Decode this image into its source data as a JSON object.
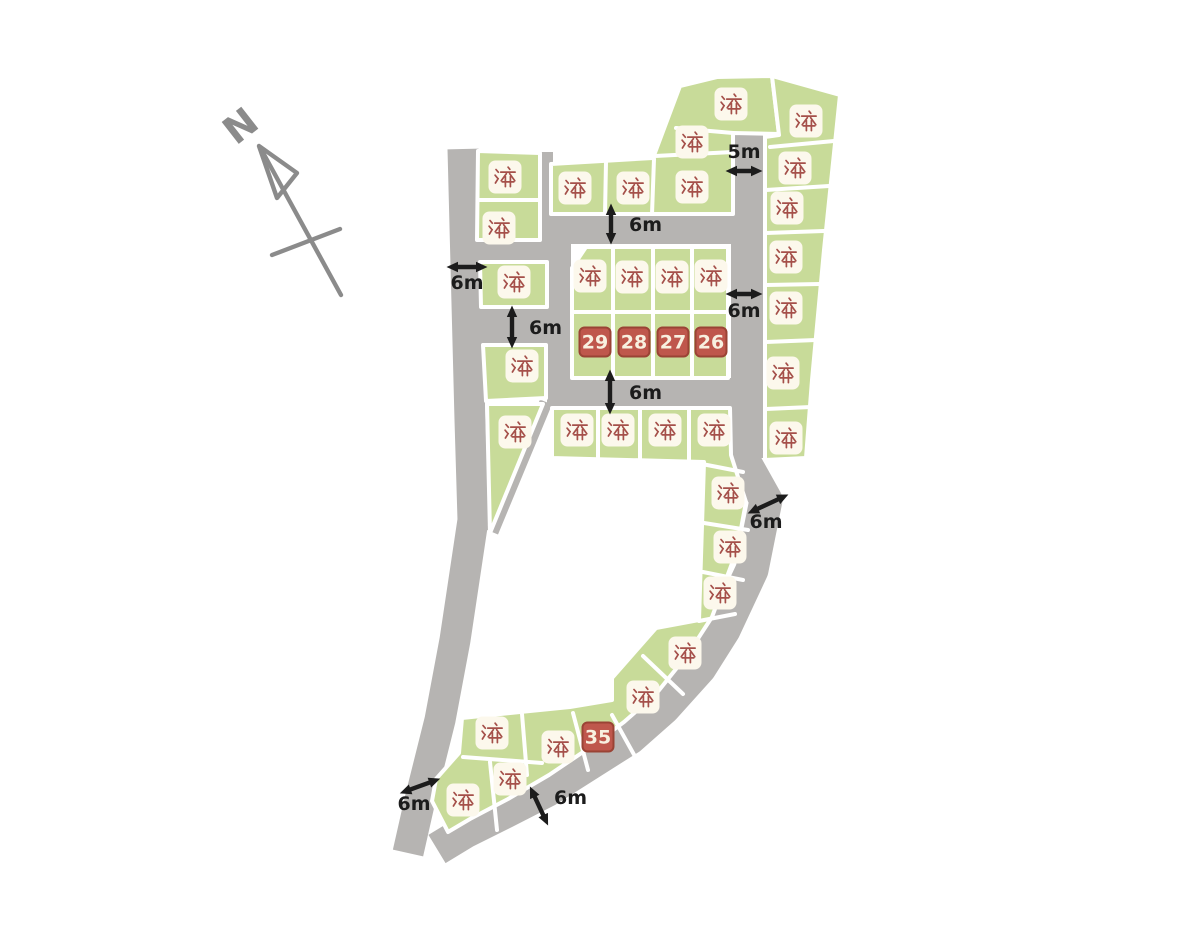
{
  "map": {
    "title": "housing-subdivision-lot-map",
    "colors": {
      "background": "#ffffff",
      "lot_green": "#c8db99",
      "road_gray": "#b6b4b2",
      "boundary_white": "#ffffff",
      "sold_box": "#fcf8ec",
      "sold_text": "#a5504a",
      "available_fill": "#bf574c",
      "available_border": "#9a4335",
      "available_text": "#f8f0e0",
      "annotation_ink": "#1c1c1c",
      "compass_gray": "#8b8b8b"
    },
    "compass": {
      "label": "N"
    },
    "legend": {
      "sold_label": "済",
      "available_lot_numbers": [
        "29",
        "28",
        "27",
        "26",
        "35"
      ]
    },
    "lots": [
      {
        "id": "lot-01",
        "status": "sold",
        "label": "済",
        "x": 505,
        "y": 177
      },
      {
        "id": "lot-02",
        "status": "sold",
        "label": "済",
        "x": 499,
        "y": 228
      },
      {
        "id": "lot-03",
        "status": "sold",
        "label": "済",
        "x": 514,
        "y": 282
      },
      {
        "id": "lot-04",
        "status": "sold",
        "label": "済",
        "x": 522,
        "y": 366
      },
      {
        "id": "lot-05",
        "status": "sold",
        "label": "済",
        "x": 515,
        "y": 432
      },
      {
        "id": "lot-06",
        "status": "sold",
        "label": "済",
        "x": 575,
        "y": 188
      },
      {
        "id": "lot-07",
        "status": "sold",
        "label": "済",
        "x": 633,
        "y": 188
      },
      {
        "id": "lot-08",
        "status": "sold",
        "label": "済",
        "x": 692,
        "y": 187
      },
      {
        "id": "lot-09",
        "status": "sold",
        "label": "済",
        "x": 731,
        "y": 104
      },
      {
        "id": "lot-10",
        "status": "sold",
        "label": "済",
        "x": 692,
        "y": 142
      },
      {
        "id": "lot-11",
        "status": "sold",
        "label": "済",
        "x": 806,
        "y": 121
      },
      {
        "id": "lot-12",
        "status": "sold",
        "label": "済",
        "x": 795,
        "y": 168
      },
      {
        "id": "lot-13",
        "status": "sold",
        "label": "済",
        "x": 787,
        "y": 208
      },
      {
        "id": "lot-14",
        "status": "sold",
        "label": "済",
        "x": 786,
        "y": 257
      },
      {
        "id": "lot-15",
        "status": "sold",
        "label": "済",
        "x": 786,
        "y": 308
      },
      {
        "id": "lot-16",
        "status": "sold",
        "label": "済",
        "x": 783,
        "y": 373
      },
      {
        "id": "lot-17",
        "status": "sold",
        "label": "済",
        "x": 786,
        "y": 438
      },
      {
        "id": "lot-18",
        "status": "sold",
        "label": "済",
        "x": 590,
        "y": 276
      },
      {
        "id": "lot-19",
        "status": "sold",
        "label": "済",
        "x": 632,
        "y": 277
      },
      {
        "id": "lot-20",
        "status": "sold",
        "label": "済",
        "x": 672,
        "y": 277
      },
      {
        "id": "lot-21",
        "status": "sold",
        "label": "済",
        "x": 711,
        "y": 276
      },
      {
        "id": "lot-22",
        "status": "sold",
        "label": "済",
        "x": 577,
        "y": 430
      },
      {
        "id": "lot-23",
        "status": "sold",
        "label": "済",
        "x": 618,
        "y": 430
      },
      {
        "id": "lot-24",
        "status": "sold",
        "label": "済",
        "x": 665,
        "y": 430
      },
      {
        "id": "lot-25",
        "status": "sold",
        "label": "済",
        "x": 714,
        "y": 430
      },
      {
        "id": "lot-26s",
        "status": "sold",
        "label": "済",
        "x": 728,
        "y": 493
      },
      {
        "id": "lot-27s",
        "status": "sold",
        "label": "済",
        "x": 730,
        "y": 547
      },
      {
        "id": "lot-28s",
        "status": "sold",
        "label": "済",
        "x": 720,
        "y": 593
      },
      {
        "id": "lot-29s",
        "status": "sold",
        "label": "済",
        "x": 685,
        "y": 653
      },
      {
        "id": "lot-30",
        "status": "sold",
        "label": "済",
        "x": 643,
        "y": 697
      },
      {
        "id": "lot-31",
        "status": "sold",
        "label": "済",
        "x": 492,
        "y": 733
      },
      {
        "id": "lot-32",
        "status": "sold",
        "label": "済",
        "x": 558,
        "y": 747
      },
      {
        "id": "lot-33",
        "status": "sold",
        "label": "済",
        "x": 510,
        "y": 779
      },
      {
        "id": "lot-34",
        "status": "sold",
        "label": "済",
        "x": 463,
        "y": 800
      },
      {
        "id": "lot-29",
        "status": "available",
        "label": "29",
        "x": 595,
        "y": 342
      },
      {
        "id": "lot-28",
        "status": "available",
        "label": "28",
        "x": 634,
        "y": 342
      },
      {
        "id": "lot-27",
        "status": "available",
        "label": "27",
        "x": 673,
        "y": 342
      },
      {
        "id": "lot-26",
        "status": "available",
        "label": "26",
        "x": 711,
        "y": 342
      },
      {
        "id": "lot-35",
        "status": "available",
        "label": "35",
        "x": 598,
        "y": 737
      }
    ],
    "annotations": [
      {
        "id": "w-5m-top",
        "text": "5m",
        "tx": 744,
        "ty": 158,
        "anchor": "middle",
        "ax": 744,
        "ay": 171,
        "len": 34,
        "angle": 0
      },
      {
        "id": "w-6m-road1",
        "text": "6m",
        "tx": 629,
        "ty": 231,
        "anchor": "start",
        "ax": 611,
        "ay": 224,
        "len": 38,
        "angle": 90
      },
      {
        "id": "w-6m-left",
        "text": "6m",
        "tx": 467,
        "ty": 289,
        "anchor": "middle",
        "ax": 467,
        "ay": 267,
        "len": 38,
        "angle": 0
      },
      {
        "id": "w-6m-right",
        "text": "6m",
        "tx": 744,
        "ty": 317,
        "anchor": "middle",
        "ax": 744,
        "ay": 294,
        "len": 34,
        "angle": 0
      },
      {
        "id": "w-6m-conn",
        "text": "6m",
        "tx": 529,
        "ty": 334,
        "anchor": "start",
        "ax": 512,
        "ay": 327,
        "len": 40,
        "angle": 90
      },
      {
        "id": "w-6m-road2",
        "text": "6m",
        "tx": 629,
        "ty": 399,
        "anchor": "start",
        "ax": 610,
        "ay": 392,
        "len": 42,
        "angle": 90
      },
      {
        "id": "w-6m-diag",
        "text": "6m",
        "tx": 766,
        "ty": 528,
        "anchor": "middle",
        "ax": 768,
        "ay": 504,
        "len": 42,
        "angle": -25
      },
      {
        "id": "w-6m-bottomleft",
        "text": "6m",
        "tx": 414,
        "ty": 810,
        "anchor": "middle",
        "ax": 420,
        "ay": 786,
        "len": 40,
        "angle": -20
      },
      {
        "id": "w-6m-bottom",
        "text": "6m",
        "tx": 554,
        "ty": 804,
        "anchor": "start",
        "ax": 539,
        "ay": 806,
        "len": 40,
        "angle": 65
      }
    ]
  }
}
